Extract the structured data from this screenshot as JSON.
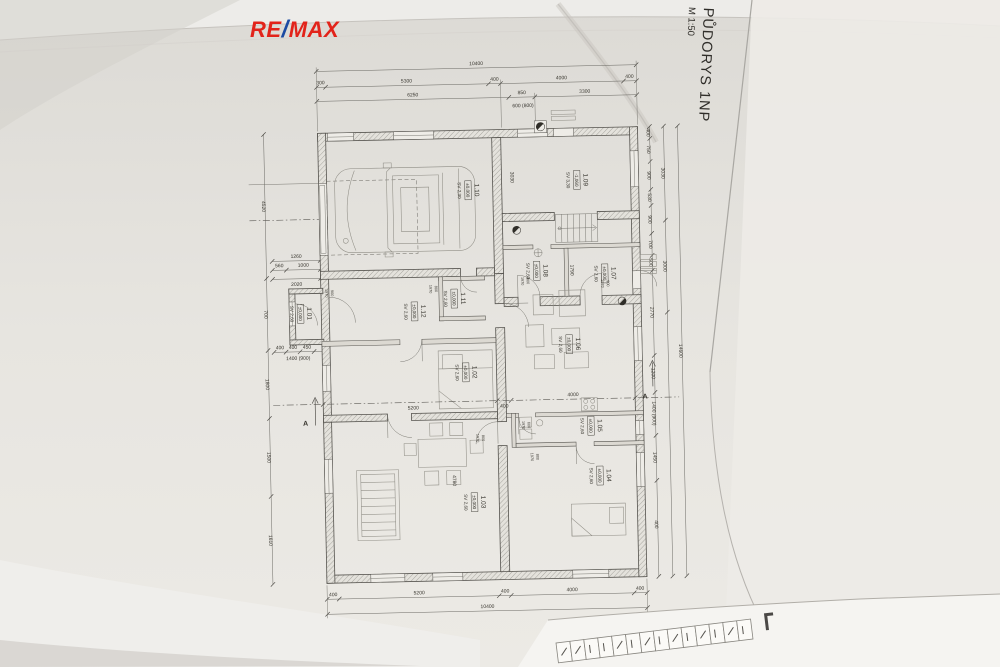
{
  "logo": {
    "re": "RE",
    "slash": "/",
    "max": "MAX"
  },
  "titleblock": {
    "title": "PŮDORYS 1NP",
    "scale": "M 1:50"
  },
  "colors": {
    "logo_red": "#e2231a",
    "logo_blue": "#1b4aa2",
    "paper": "#e7e5e0",
    "ink": "#38362f"
  },
  "rooms": [
    {
      "id": "1.10",
      "level": "±0,000",
      "sv": "SV 2,30"
    },
    {
      "id": "1.09",
      "level": "-1,060",
      "sv": "SV 3,30"
    },
    {
      "id": "1.08",
      "level": "±0,000",
      "sv": "SV 2,60"
    },
    {
      "id": "1.07",
      "level": "±0,000",
      "sv": "SV 2,60"
    },
    {
      "id": "1.11",
      "level": "±0,000",
      "sv": "SV 2,60"
    },
    {
      "id": "1.12",
      "level": "±0,000",
      "sv": "SV 2,60"
    },
    {
      "id": "1.01",
      "level": "±0,000",
      "sv": "SV 2,60"
    },
    {
      "id": "1.02",
      "level": "±0,000",
      "sv": "SV 2,60"
    },
    {
      "id": "1.06",
      "level": "±0,000",
      "sv": "SV 2,60"
    },
    {
      "id": "1.05",
      "level": "±0,000",
      "sv": "SV 2,60"
    },
    {
      "id": "1.03",
      "level": "±0,000",
      "sv": "SV 2,60"
    },
    {
      "id": "1.04",
      "level": "±0,000",
      "sv": "SV 2,60"
    }
  ],
  "dims": {
    "top_total": "10400",
    "top_row2": [
      "300",
      "5300",
      "400",
      "4000",
      "400"
    ],
    "top_row3": [
      "6250",
      "850",
      "3300"
    ],
    "top_note": "600 (800)",
    "bottom_row": [
      "400",
      "5200",
      "400",
      "4000",
      "400"
    ],
    "bottom_total": "10400",
    "left_col": [
      "4520",
      "700",
      "1800",
      "1500",
      "1610"
    ],
    "left_mini1": "1260",
    "left_mini2a": "560",
    "left_mini2b": "1000",
    "left_mini3": "2020",
    "left_mini4": [
      "400",
      "400",
      "450"
    ],
    "left_note": "1400 (900)",
    "right_col1": [
      "400",
      "750",
      "900",
      "530",
      "900",
      "700",
      "500",
      "2770",
      "1200",
      "1400 (900)",
      "1450",
      "400"
    ],
    "right_col2": [
      "3030",
      "3000"
    ],
    "right_total": "14600",
    "interior": {
      "r109_w": "3030",
      "sec_a": "5200",
      "sec_b": "400",
      "sec_c": "4000",
      "r103_h": "4780",
      "r108_h": "1790"
    }
  },
  "doors": [
    {
      "w": "800",
      "h": "1970"
    },
    {
      "w": "800",
      "h": "1970"
    },
    {
      "w": "900",
      "h": "1970"
    },
    {
      "w": "800",
      "h": "1970"
    },
    {
      "w": "800",
      "h": "1970"
    },
    {
      "w": "600",
      "h": "1970"
    },
    {
      "w": "900",
      "h": "1970"
    }
  ],
  "section": {
    "label": "A"
  }
}
